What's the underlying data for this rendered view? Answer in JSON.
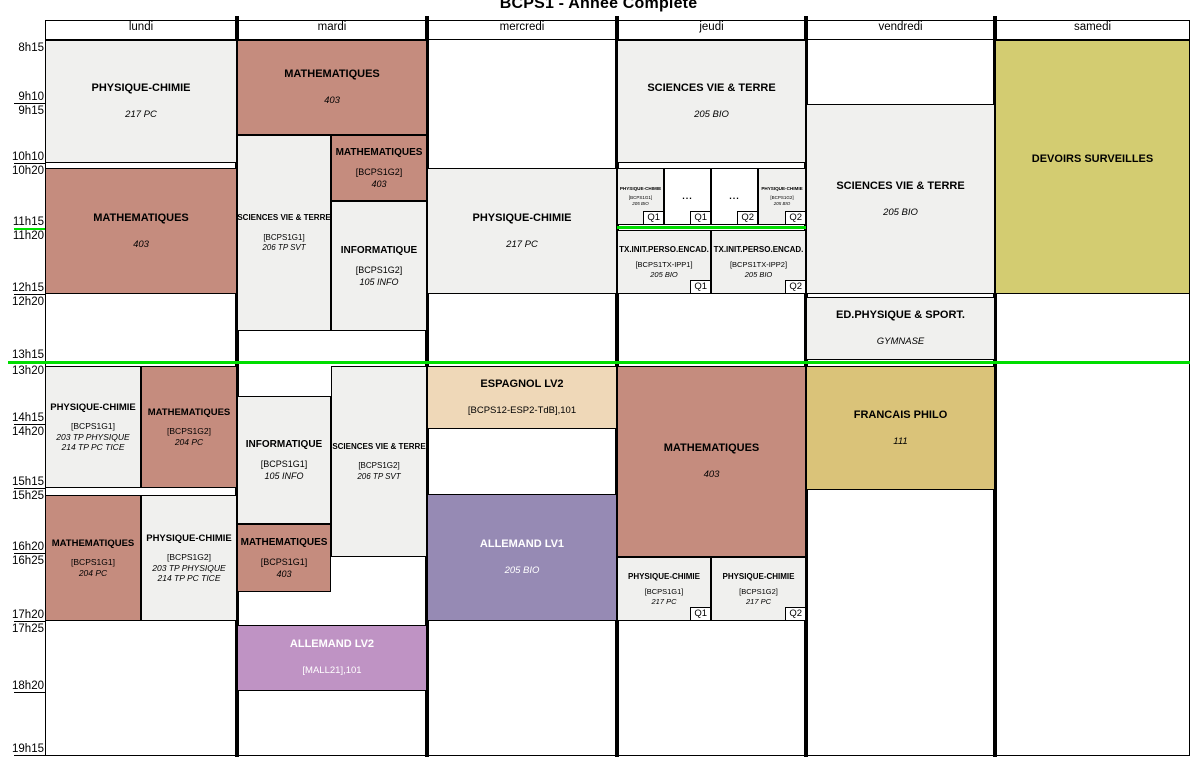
{
  "title": "BCPS1 - Année Complète",
  "colors": {
    "salmon": "#c58c7e",
    "gray": "#f0f0ee",
    "olive": "#d3cc71",
    "gold": "#dac379",
    "purple": "#968ab4",
    "mauve": "#bf93c4",
    "tan": "#efd8b8",
    "white": "#ffffff",
    "separator_green": "#00dd00",
    "grid_black": "#000000"
  },
  "days": [
    {
      "label": "lundi",
      "x": 45,
      "w": 192
    },
    {
      "label": "mardi",
      "x": 237,
      "w": 190
    },
    {
      "label": "mercredi",
      "x": 427,
      "w": 190
    },
    {
      "label": "jeudi",
      "x": 617,
      "w": 189
    },
    {
      "label": "vendredi",
      "x": 806,
      "w": 189
    },
    {
      "label": "samedi",
      "x": 995,
      "w": 195
    }
  ],
  "time_labels": [
    {
      "text": "8h15",
      "y": 42
    },
    {
      "text": "9h10",
      "y": 91,
      "tick": 103
    },
    {
      "text": "9h15",
      "y": 105
    },
    {
      "text": "10h10",
      "y": 151,
      "tick": 163
    },
    {
      "text": "10h20",
      "y": 165
    },
    {
      "text": "11h15",
      "y": 216,
      "tick": 228,
      "tick_color": "separator_green"
    },
    {
      "text": "11h20",
      "y": 230
    },
    {
      "text": "12h15",
      "y": 282,
      "tick": 294
    },
    {
      "text": "12h20",
      "y": 296
    },
    {
      "text": "13h15",
      "y": 349,
      "tick": 361,
      "tick_color": "separator_green"
    },
    {
      "text": "13h20",
      "y": 365
    },
    {
      "text": "14h15",
      "y": 412,
      "tick": 424
    },
    {
      "text": "14h20",
      "y": 426
    },
    {
      "text": "15h15",
      "y": 476,
      "tick": 488
    },
    {
      "text": "15h25",
      "y": 490
    },
    {
      "text": "16h20",
      "y": 541,
      "tick": 553
    },
    {
      "text": "16h25",
      "y": 555
    },
    {
      "text": "17h20",
      "y": 609,
      "tick": 621
    },
    {
      "text": "17h25",
      "y": 623
    },
    {
      "text": "18h20",
      "y": 680,
      "tick": 692
    },
    {
      "text": "19h15",
      "y": 743,
      "tick": 755
    }
  ],
  "separators": [
    {
      "x": 8,
      "y": 361,
      "w": 1182,
      "h": 3
    },
    {
      "x": 617,
      "y": 226,
      "w": 189,
      "h": 3
    }
  ],
  "cells": [
    {
      "day": "lundi",
      "x": 45,
      "y": 40,
      "w": 192,
      "h": 123,
      "color": "gray",
      "variant": "n",
      "lines": [
        [
          "PHYSIQUE-CHIMIE",
          "t"
        ],
        [
          "217 PC",
          "r"
        ]
      ]
    },
    {
      "day": "lundi",
      "x": 45,
      "y": 168,
      "w": 192,
      "h": 126,
      "color": "salmon",
      "variant": "n",
      "lines": [
        [
          "MATHEMATIQUES",
          "t"
        ],
        [
          "403",
          "r"
        ]
      ]
    },
    {
      "day": "lundi",
      "x": 45,
      "y": 366,
      "w": 96,
      "h": 122,
      "color": "gray",
      "variant": "h",
      "lines": [
        [
          "PHYSIQUE-CHIMIE",
          "t"
        ],
        [
          "[BCPS1G1]",
          "g"
        ],
        [
          "203 TP PHYSIQUE",
          "r"
        ],
        [
          "214 TP PC TICE",
          "r"
        ]
      ]
    },
    {
      "day": "lundi",
      "x": 141,
      "y": 366,
      "w": 96,
      "h": 122,
      "color": "salmon",
      "variant": "h",
      "lines": [
        [
          "MATHEMATIQUES",
          "t"
        ],
        [
          "[BCPS1G2]",
          "g"
        ],
        [
          "204 PC",
          "r"
        ]
      ]
    },
    {
      "day": "lundi",
      "x": 45,
      "y": 495,
      "w": 96,
      "h": 126,
      "color": "salmon",
      "variant": "h",
      "lines": [
        [
          "MATHEMATIQUES",
          "t"
        ],
        [
          "[BCPS1G1]",
          "g"
        ],
        [
          "204 PC",
          "r"
        ]
      ]
    },
    {
      "day": "lundi",
      "x": 141,
      "y": 495,
      "w": 96,
      "h": 126,
      "color": "gray",
      "variant": "h",
      "lines": [
        [
          "PHYSIQUE-CHIMIE",
          "t"
        ],
        [
          "[BCPS1G2]",
          "g"
        ],
        [
          "203 TP PHYSIQUE",
          "r"
        ],
        [
          "214 TP PC TICE",
          "r"
        ]
      ]
    },
    {
      "day": "mardi",
      "x": 237,
      "y": 40,
      "w": 190,
      "h": 95,
      "color": "salmon",
      "variant": "n",
      "lines": [
        [
          "MATHEMATIQUES",
          "t"
        ],
        [
          "403",
          "r"
        ]
      ]
    },
    {
      "day": "mardi",
      "x": 237,
      "y": 135,
      "w": 94,
      "h": 196,
      "color": "gray",
      "variant": "m",
      "lines": [
        [
          "SCIENCES VIE & TERRE",
          "t"
        ],
        [
          "[BCPS1G1]",
          "g"
        ],
        [
          "206 TP SVT",
          "r"
        ]
      ]
    },
    {
      "day": "mardi",
      "x": 331,
      "y": 135,
      "w": 96,
      "h": 66,
      "color": "salmon",
      "variant": "i",
      "lines": [
        [
          "MATHEMATIQUES",
          "t"
        ],
        [
          "[BCPS1G2]",
          "g"
        ],
        [
          "403",
          "r"
        ]
      ]
    },
    {
      "day": "mardi",
      "x": 331,
      "y": 201,
      "w": 96,
      "h": 130,
      "color": "gray",
      "variant": "i",
      "lines": [
        [
          "INFORMATIQUE",
          "t"
        ],
        [
          "[BCPS1G2]",
          "g"
        ],
        [
          "105 INFO",
          "r"
        ]
      ]
    },
    {
      "day": "mardi",
      "x": 331,
      "y": 366,
      "w": 96,
      "h": 191,
      "color": "gray",
      "variant": "m",
      "lines": [
        [
          "SCIENCES VIE & TERRE",
          "t"
        ],
        [
          "[BCPS1G2]",
          "g"
        ],
        [
          "206 TP SVT",
          "r"
        ]
      ]
    },
    {
      "day": "mardi",
      "x": 237,
      "y": 396,
      "w": 94,
      "h": 128,
      "color": "gray",
      "variant": "i",
      "lines": [
        [
          "INFORMATIQUE",
          "t"
        ],
        [
          "[BCPS1G1]",
          "g"
        ],
        [
          "105 INFO",
          "r"
        ]
      ]
    },
    {
      "day": "mardi",
      "x": 237,
      "y": 524,
      "w": 94,
      "h": 68,
      "color": "salmon",
      "variant": "i",
      "lines": [
        [
          "MATHEMATIQUES",
          "t"
        ],
        [
          "[BCPS1G1]",
          "g"
        ],
        [
          "403",
          "r"
        ]
      ]
    },
    {
      "day": "mardi",
      "x": 237,
      "y": 625,
      "w": 190,
      "h": 66,
      "color": "mauve",
      "variant": "n",
      "text_color": "white",
      "lines": [
        [
          "ALLEMAND LV2",
          "t"
        ],
        [
          "[MALL21],101",
          "g"
        ]
      ]
    },
    {
      "day": "mercredi",
      "x": 427,
      "y": 168,
      "w": 190,
      "h": 126,
      "color": "gray",
      "variant": "n",
      "lines": [
        [
          "PHYSIQUE-CHIMIE",
          "t"
        ],
        [
          "217 PC",
          "r"
        ]
      ]
    },
    {
      "day": "mercredi",
      "x": 427,
      "y": 366,
      "w": 190,
      "h": 63,
      "color": "tan",
      "variant": "n",
      "lines": [
        [
          "ESPAGNOL LV2",
          "t"
        ],
        [
          "[BCPS12-ESP2-TdB],101",
          "g"
        ]
      ]
    },
    {
      "day": "mercredi",
      "x": 427,
      "y": 494,
      "w": 190,
      "h": 127,
      "color": "purple",
      "variant": "n",
      "text_color": "white",
      "lines": [
        [
          "ALLEMAND LV1",
          "t"
        ],
        [
          "205 BIO",
          "r"
        ]
      ]
    },
    {
      "day": "jeudi",
      "x": 617,
      "y": 40,
      "w": 189,
      "h": 123,
      "color": "gray",
      "variant": "n",
      "lines": [
        [
          "SCIENCES VIE & TERRE",
          "t"
        ],
        [
          "205 BIO",
          "r"
        ]
      ]
    },
    {
      "day": "jeudi",
      "x": 617,
      "y": 168,
      "w": 47,
      "h": 57,
      "color": "gray",
      "variant": "t",
      "quarter": "Q1",
      "lines": [
        [
          "PHYSIQUE-CHIMIE",
          "t"
        ],
        [
          "[BCPS1G1]",
          "g"
        ],
        [
          "205 BIO",
          "r"
        ]
      ]
    },
    {
      "day": "jeudi",
      "x": 664,
      "y": 168,
      "w": 47,
      "h": 57,
      "color": "white",
      "variant": "d",
      "quarter": "Q1",
      "lines": [
        [
          "...",
          "t"
        ]
      ]
    },
    {
      "day": "jeudi",
      "x": 711,
      "y": 168,
      "w": 47,
      "h": 57,
      "color": "white",
      "variant": "d",
      "quarter": "Q2",
      "lines": [
        [
          "...",
          "t"
        ]
      ]
    },
    {
      "day": "jeudi",
      "x": 758,
      "y": 168,
      "w": 48,
      "h": 57,
      "color": "gray",
      "variant": "t",
      "quarter": "Q2",
      "lines": [
        [
          "PHYSIQUE-CHIMIE",
          "t"
        ],
        [
          "[BCPS1G2]",
          "g"
        ],
        [
          "205 BIO",
          "r"
        ]
      ]
    },
    {
      "day": "jeudi",
      "x": 617,
      "y": 230,
      "w": 94,
      "h": 64,
      "color": "gray",
      "variant": "s",
      "quarter": "Q1",
      "lines": [
        [
          "TX.INIT.PERSO.ENCAD.",
          "t"
        ],
        [
          "[BCPS1TX-IPP1]",
          "g"
        ],
        [
          "205 BIO",
          "r"
        ]
      ]
    },
    {
      "day": "jeudi",
      "x": 711,
      "y": 230,
      "w": 95,
      "h": 64,
      "color": "gray",
      "variant": "s",
      "quarter": "Q2",
      "lines": [
        [
          "TX.INIT.PERSO.ENCAD.",
          "t"
        ],
        [
          "[BCPS1TX-IPP2]",
          "g"
        ],
        [
          "205 BIO",
          "r"
        ]
      ]
    },
    {
      "day": "jeudi",
      "x": 617,
      "y": 366,
      "w": 189,
      "h": 191,
      "color": "salmon",
      "variant": "n",
      "lines": [
        [
          "MATHEMATIQUES",
          "t"
        ],
        [
          "403",
          "r"
        ]
      ]
    },
    {
      "day": "jeudi",
      "x": 617,
      "y": 557,
      "w": 94,
      "h": 64,
      "color": "gray",
      "variant": "s",
      "quarter": "Q1",
      "lines": [
        [
          "PHYSIQUE-CHIMIE",
          "t"
        ],
        [
          "[BCPS1G1]",
          "g"
        ],
        [
          "217 PC",
          "r"
        ]
      ]
    },
    {
      "day": "jeudi",
      "x": 711,
      "y": 557,
      "w": 95,
      "h": 64,
      "color": "gray",
      "variant": "s",
      "quarter": "Q2",
      "lines": [
        [
          "PHYSIQUE-CHIMIE",
          "t"
        ],
        [
          "[BCPS1G2]",
          "g"
        ],
        [
          "217 PC",
          "r"
        ]
      ]
    },
    {
      "day": "vendredi",
      "x": 806,
      "y": 104,
      "w": 189,
      "h": 190,
      "color": "gray",
      "variant": "n",
      "lines": [
        [
          "SCIENCES VIE & TERRE",
          "t"
        ],
        [
          "205 BIO",
          "r"
        ]
      ]
    },
    {
      "day": "vendredi",
      "x": 806,
      "y": 297,
      "w": 189,
      "h": 63,
      "color": "gray",
      "variant": "n",
      "lines": [
        [
          "ED.PHYSIQUE & SPORT.",
          "t"
        ],
        [
          "GYMNASE",
          "r"
        ]
      ]
    },
    {
      "day": "vendredi",
      "x": 806,
      "y": 366,
      "w": 189,
      "h": 124,
      "color": "gold",
      "variant": "n",
      "lines": [
        [
          "FRANCAIS PHILO",
          "t"
        ],
        [
          "111",
          "r"
        ]
      ]
    },
    {
      "day": "samedi",
      "x": 995,
      "y": 40,
      "w": 195,
      "h": 254,
      "color": "olive",
      "variant": "n",
      "lines": [
        [
          "DEVOIRS SURVEILLES",
          "t"
        ]
      ]
    }
  ],
  "frame": [
    {
      "x": 45,
      "y": 20,
      "w": 1145,
      "h": 1
    },
    {
      "x": 45,
      "y": 39,
      "w": 1145,
      "h": 1
    },
    {
      "x": 45,
      "y": 755,
      "w": 1145,
      "h": 1
    },
    {
      "x": 45,
      "y": 20,
      "w": 1,
      "h": 736
    },
    {
      "x": 1189,
      "y": 20,
      "w": 1,
      "h": 736
    },
    {
      "x": 235,
      "y": 16,
      "w": 4,
      "h": 741
    },
    {
      "x": 425,
      "y": 16,
      "w": 4,
      "h": 741
    },
    {
      "x": 615,
      "y": 16,
      "w": 4,
      "h": 741
    },
    {
      "x": 804,
      "y": 16,
      "w": 4,
      "h": 741
    },
    {
      "x": 993,
      "y": 16,
      "w": 4,
      "h": 741
    }
  ]
}
